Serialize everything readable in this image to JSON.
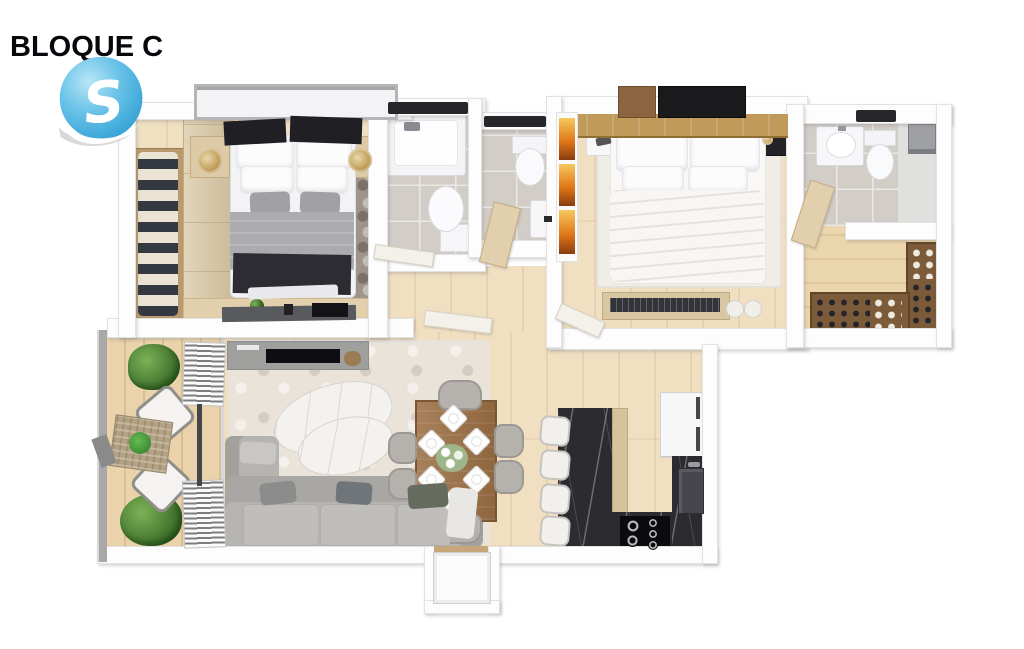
{
  "header": {
    "title": "BLOQUE C",
    "logo_letter": "S"
  },
  "palette": {
    "brand_blue": "#4fb3e2",
    "brand_blue_dark": "#2f9fd4",
    "title_color": "#07070c",
    "wall": "#fdfdfd",
    "wood_floor": "#f0dfc1",
    "balcony_deck": "#ead3ab",
    "closet_floor": "#ecd6ad",
    "tile_gray": "#d3cdc8",
    "rug_gray": "#9e948c",
    "rug_living": "#e9e3da",
    "rug_master": "#f0ede7",
    "island_marble": "#2b2b30",
    "sofa_gray": "#b6b4b1",
    "bed_dark_throw": "#2c2c32",
    "headboard_oak": "#bf9a58",
    "wardrobe_beige": "#d8c6a2",
    "closet_wood": "#7b5b39",
    "accent_orange": "#e07818",
    "plant_green": "#4a7c33",
    "dining_wood": "#9b6f44"
  },
  "floorplan": {
    "type": "apartment-3d-top-view",
    "rooms": [
      {
        "name": "bedroom-secondary",
        "furniture": [
          "double-bed",
          "open-wardrobe-with-clothes",
          "wardrobe-doors",
          "two-nightstands",
          "two-table-lamps",
          "area-rug",
          "dresser-with-tv",
          "window"
        ]
      },
      {
        "name": "bathroom-main",
        "furniture": [
          "bathtub-shower",
          "toilet",
          "glass-screen"
        ]
      },
      {
        "name": "bathroom-guest",
        "furniture": [
          "toilet",
          "washbasin"
        ]
      },
      {
        "name": "bedroom-master",
        "furniture": [
          "double-bed-white",
          "oak-headboard-panel",
          "wall-shelves",
          "two-nightstands",
          "area-rug",
          "bench-with-poufs",
          "orange-wall-art"
        ]
      },
      {
        "name": "bathroom-ensuite",
        "furniture": [
          "washbasin-unit",
          "toilet",
          "shower"
        ]
      },
      {
        "name": "walk-in-closet",
        "furniture": [
          "shoe-rack-right",
          "shoe-rack-bottom"
        ]
      },
      {
        "name": "living-room",
        "furniture": [
          "corner-sofa",
          "marble-coffee-tables",
          "tv-console",
          "area-rug"
        ]
      },
      {
        "name": "balcony",
        "furniture": [
          "two-lounge-chairs",
          "wicker-side-table",
          "potted-plants",
          "vertical-blinds",
          "glass-railing"
        ]
      },
      {
        "name": "dining-room",
        "furniture": [
          "wood-dining-table",
          "six-chairs",
          "six-place-settings",
          "floral-centerpiece"
        ]
      },
      {
        "name": "kitchen",
        "furniture": [
          "dark-marble-island",
          "four-bar-stools",
          "gas-cooktop",
          "refrigerator",
          "sink-counter"
        ]
      },
      {
        "name": "entrance",
        "furniture": [
          "front-door-alcove"
        ]
      }
    ]
  }
}
